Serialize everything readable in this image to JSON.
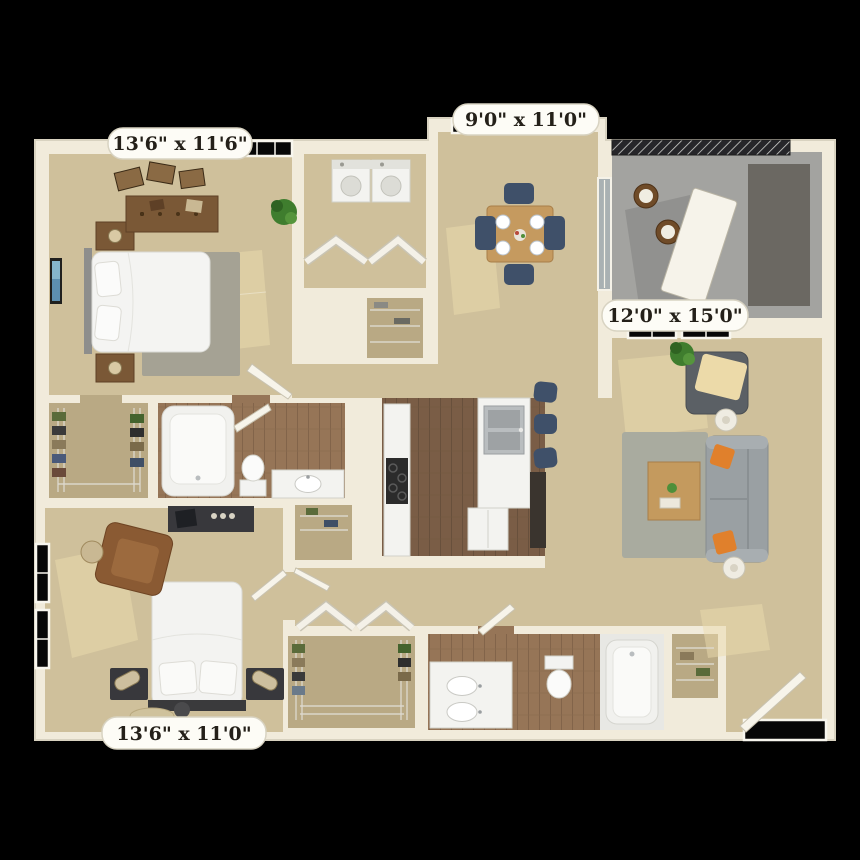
{
  "image": {
    "kind": "3d-apartment-floor-plan-render",
    "background_color": "#000000",
    "wall_color": "#f1ebdb",
    "carpet_color": "#cfc09b",
    "wood_floor_color": "#7a5d46"
  },
  "dimension_labels": {
    "bedroom_top_left": "13'6\" x 11'6\"",
    "dining_nook": "9'0\" x 11'0\"",
    "living_room": "12'0\" x 15'0\"",
    "bedroom_bottom_left": "13'6\" x 11'0\""
  },
  "rooms": [
    {
      "name": "bedroom-1",
      "dimensions": "13'6\" x 11'6\"",
      "floor": "carpet",
      "furniture": [
        "queen bed",
        "two nightstands with lamps",
        "dresser",
        "picture frames",
        "area rug",
        "potted plant",
        "wall art"
      ]
    },
    {
      "name": "laundry-closet",
      "floor": "carpet",
      "furniture": [
        "washer",
        "dryer",
        "bifold doors"
      ]
    },
    {
      "name": "dining-nook",
      "dimensions": "9'0\" x 11'0\"",
      "floor": "carpet",
      "furniture": [
        "square table",
        "four navy chairs",
        "place settings"
      ]
    },
    {
      "name": "balcony",
      "floor": "concrete",
      "furniture": [
        "railing",
        "two bistro chairs",
        "storage closet",
        "leaning door panel"
      ]
    },
    {
      "name": "living-room",
      "dimensions": "12'0\" x 15'0\"",
      "floor": "carpet",
      "furniture": [
        "gray sofa with orange pillows",
        "armchair with throw",
        "coffee table",
        "area rug",
        "two lamp side tables",
        "potted plant"
      ]
    },
    {
      "name": "kitchen",
      "floor": "wood",
      "furniture": [
        "cooktop counter",
        "double sink counter",
        "refrigerator",
        "three navy bar stools"
      ]
    },
    {
      "name": "bathroom-1",
      "floor": "wood",
      "furniture": [
        "bathtub",
        "toilet",
        "single sink vanity"
      ]
    },
    {
      "name": "walk-in-closet-1",
      "floor": "carpet",
      "furniture": [
        "wire shelving",
        "clothes"
      ]
    },
    {
      "name": "bedroom-2",
      "dimensions": "13'6\" x 11'0\"",
      "floor": "carpet",
      "furniture": [
        "queen bed",
        "two dark nightstands with lamps",
        "leather armchair",
        "media console",
        "round side table"
      ]
    },
    {
      "name": "walk-in-closet-2",
      "floor": "carpet",
      "furniture": [
        "wire shelving",
        "clothes",
        "bifold doors"
      ]
    },
    {
      "name": "bathroom-2",
      "floor": "wood",
      "furniture": [
        "double sink vanity",
        "toilet",
        "bathtub"
      ]
    },
    {
      "name": "entry",
      "floor": "carpet",
      "furniture": [
        "front door"
      ]
    }
  ]
}
